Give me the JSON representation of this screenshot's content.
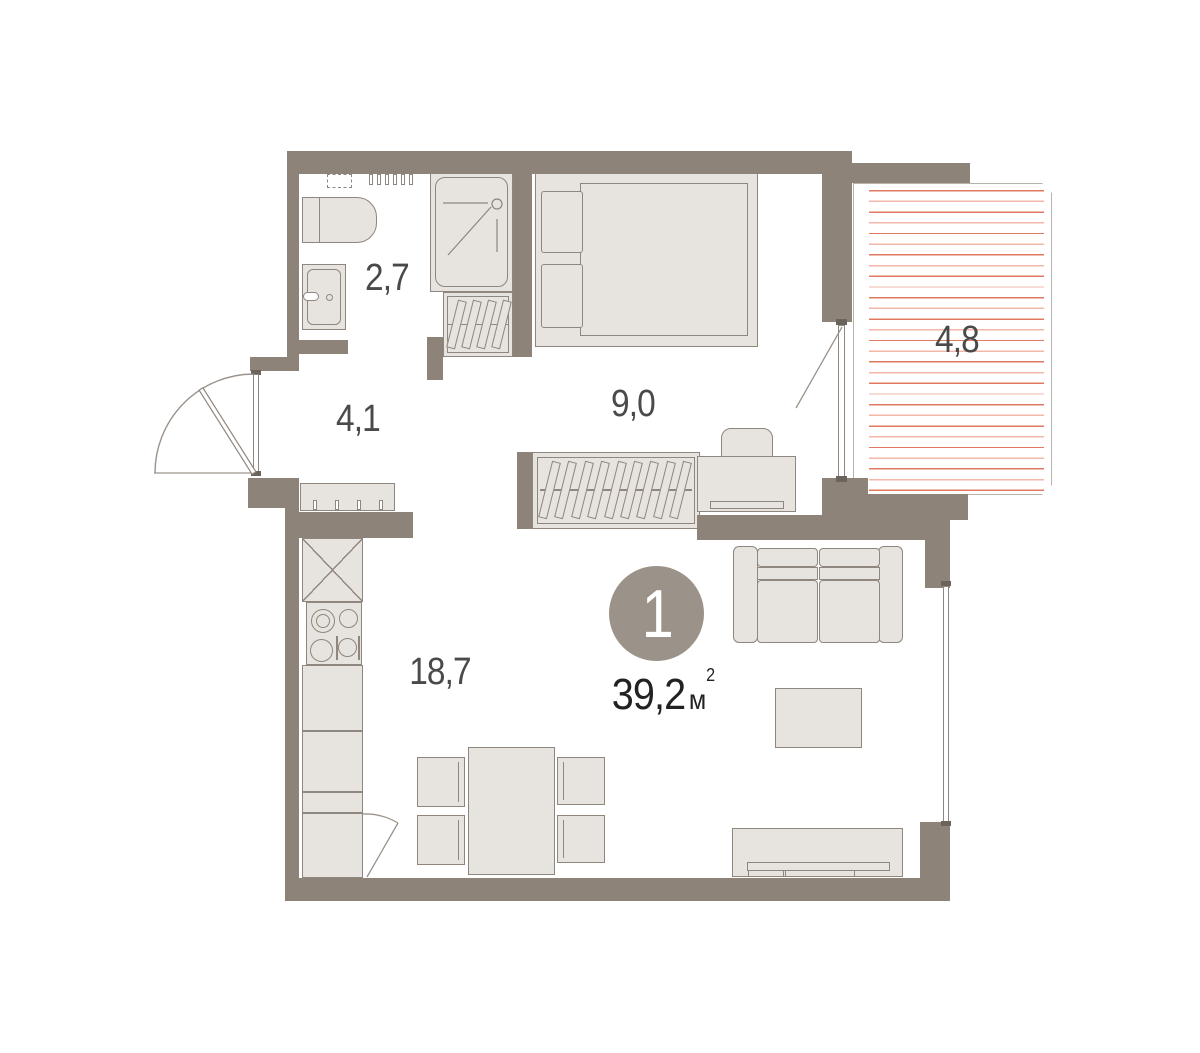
{
  "plan": {
    "unit_number": "1",
    "total_area": "39,2",
    "area_unit_letter": "м",
    "area_unit_sup": "2",
    "rooms": [
      {
        "id": "bathroom",
        "area_label": "2,7"
      },
      {
        "id": "hallway",
        "area_label": "4,1"
      },
      {
        "id": "bedroom",
        "area_label": "9,0"
      },
      {
        "id": "balcony",
        "area_label": "4,8"
      },
      {
        "id": "living-kitchen",
        "area_label": "18,7"
      }
    ],
    "colors": {
      "wall": "#8D8379",
      "furn_fill": "#E7E3DF",
      "furn_stroke": "#8F867D",
      "outline_thin": "#B8B2AD",
      "hatch_primary": "#E0795F",
      "hatch_secondary": "#F2B7A9",
      "badge": "#9B9289",
      "label": "#4A4A4A",
      "area_text": "#222222"
    }
  }
}
